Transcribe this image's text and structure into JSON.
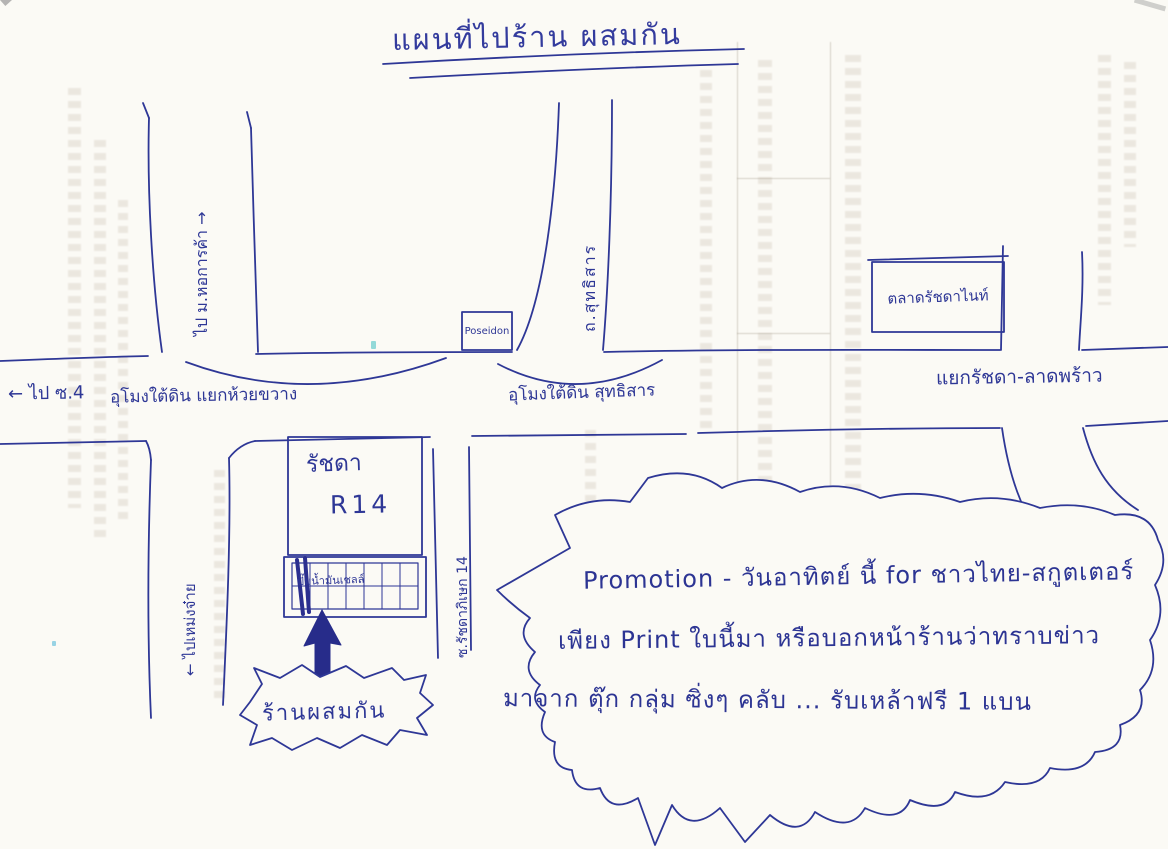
{
  "title": "แผนที่ไปร้าน ผสมกัน",
  "map": {
    "to_university": "ไป ม.หอการค้า →",
    "to_soi4": "← ไป ซ.4",
    "tunnel_huai_khwang": "อุโมงใต้ดิน แยกห้วยขวาง",
    "poseidon": "Poseidon",
    "sutthisan_road": "ถ.สุทธิสาร",
    "tunnel_sutthisan": "อุโมงใต้ดิน สุทธิสาร",
    "night_market": "ตลาดรัชดาไนท์",
    "ratchada_ladprao_junction": "แยกรัชดา-ลาดพร้าว",
    "to_mengjai": "← ไปเหม่งจ๋าย",
    "building_line1": "รัชดา",
    "building_line2": "R14",
    "gas_station": "ปั๊มน้ำมันเชลล์",
    "soi14": "ซ.รัชดาภิเษก 14",
    "shop": "ร้านผสมกัน"
  },
  "promotion": {
    "line1": "Promotion - วันอาทิตย์ นี้ for ชาวไทย-สกูตเตอร์",
    "line2": "เพียง Print ใบนี้มา หรือบอกหน้าร้านว่าทราบข่าว",
    "line3": "มาจาก ตุ๊ก กลุ่ม ซิ่งๆ คลับ ... รับเหล้าฟรี 1 แบน"
  },
  "colors": {
    "ink": "#2e3796",
    "ink_dark": "#272c8a",
    "paper": "#fbfaf5"
  }
}
